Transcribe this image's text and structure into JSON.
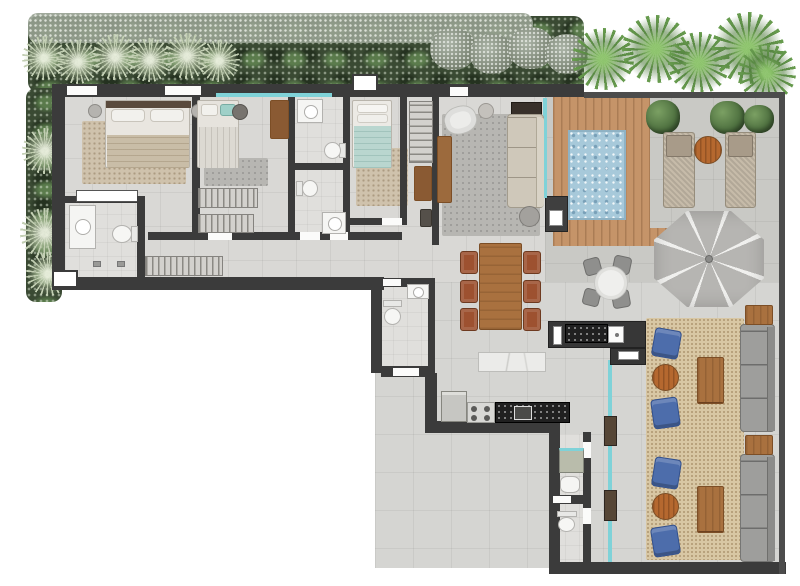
{
  "title": "penthouse-floor-plan-top-view",
  "visible_text": [],
  "palette": {
    "wall": "#3b3b3b",
    "floor_indoor": "#d9d8d5",
    "floor_mid": "#d5d5d2",
    "floor_terrace": "#c9c9c5",
    "water": "#a7c9da",
    "deck_wood": "#c59469",
    "rug_beige": "#cfc2ac",
    "rug_gray": "#b7b6b2",
    "rug_lounge": "#d8c7a4",
    "wood_furniture": "#a9713f",
    "chair_red_brown": "#9d5130",
    "chair_blue": "#4d6dab",
    "sofa_gray": "#9e9e9c",
    "sofa_beige": "#cfc8ba",
    "counter_black": "#202020",
    "marble": "#ebebe9",
    "glass_teal": "#7fd2d8",
    "veg_sage": "#c3cfb4",
    "veg_green": "#679b4e",
    "umbrella_gray": "#b6b5b2",
    "lounger": "#c6bba9"
  },
  "rooms": [
    {
      "name": "master-bedroom",
      "furniture": [
        "double-bed",
        "two-nightstands",
        "area-rug",
        "built-in-niche"
      ]
    },
    {
      "name": "master-bathroom",
      "furniture": [
        "vanity-sink",
        "toilet",
        "shower-area"
      ]
    },
    {
      "name": "bedroom-2",
      "furniture": [
        "double-bed",
        "pouf",
        "rug",
        "wood-dresser",
        "wardrobe-hatch"
      ]
    },
    {
      "name": "bathroom-2",
      "furniture": [
        "vanity-sink",
        "toilet"
      ]
    },
    {
      "name": "bathroom-3",
      "furniture": [
        "vanity-sink",
        "toilet"
      ]
    },
    {
      "name": "bedroom-3",
      "furniture": [
        "single-bed",
        "rug"
      ]
    },
    {
      "name": "entry-hall",
      "furniture": [
        "open-closet",
        "wood-console",
        "bench"
      ]
    },
    {
      "name": "corridor",
      "furniture": [
        "wardrobe-hatch"
      ]
    },
    {
      "name": "living-room",
      "furniture": [
        "armchair",
        "side-table",
        "chaise-sofa",
        "media-cabinet",
        "round-table",
        "wood-sideboard",
        "rug"
      ]
    },
    {
      "name": "pool-deck",
      "furniture": [
        "wood-deck",
        "pool",
        "equipment-box"
      ]
    },
    {
      "name": "terrace",
      "furniture": [
        "two-sun-loungers",
        "round-wood-table",
        "three-bushes",
        "parasol",
        "outdoor-round-dining-table",
        "four-outdoor-chairs"
      ]
    },
    {
      "name": "dining-area",
      "furniture": [
        "wood-table",
        "six-chairs"
      ]
    },
    {
      "name": "gourmet-bar",
      "furniture": [
        "black-counter",
        "bar-sink"
      ]
    },
    {
      "name": "kitchen",
      "furniture": [
        "island-marble",
        "fridge",
        "cooktop",
        "black-counter",
        "sink"
      ]
    },
    {
      "name": "powder-room",
      "furniture": [
        "toilet",
        "sink"
      ]
    },
    {
      "name": "laundry",
      "furniture": [
        "washer",
        "utility-sink"
      ]
    },
    {
      "name": "service-bathroom",
      "furniture": [
        "toilet"
      ]
    },
    {
      "name": "lounge-terrace",
      "furniture": [
        "rug",
        "four-blue-armchairs",
        "two-round-wood-tables",
        "two-double-coffee-tables",
        "two-gray-sofas",
        "two-wood-side-tables"
      ]
    }
  ],
  "counts": {
    "bedrooms": 3,
    "bathrooms": 5,
    "blue_armchairs": 4,
    "gray_sofas": 2,
    "sun_loungers": 2,
    "dining_chairs": 6,
    "outdoor_dining_chairs": 4
  },
  "environment": {
    "vegetation": [
      "top-garden-strip",
      "sage-palms",
      "tropical-palms-right",
      "left-garden-strip",
      "terrace-bushes"
    ],
    "background": "#ffffff"
  }
}
